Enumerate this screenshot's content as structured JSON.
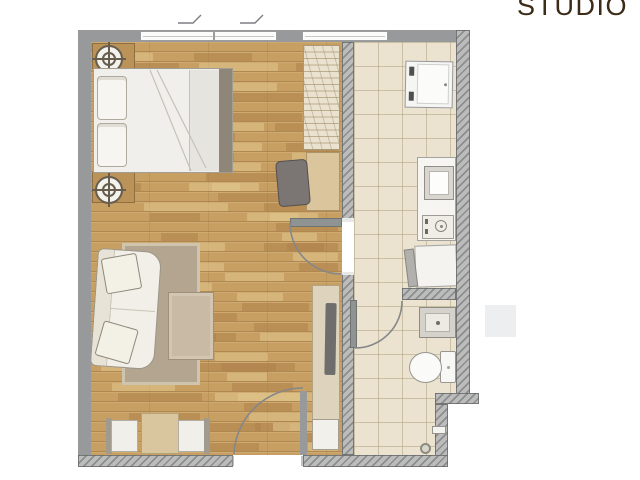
{
  "title": {
    "text": "STUDIO"
  },
  "floor_plan": {
    "type": "studio apartment floor plan",
    "rooms": [
      {
        "name": "bedroom-living-area",
        "floor": "wood"
      },
      {
        "name": "kitchen-hall",
        "floor": "tile"
      },
      {
        "name": "bathroom",
        "floor": "tile"
      }
    ],
    "furniture": [
      "nightstand-with-lamp (x2)",
      "double-bed",
      "wardrobe",
      "desk",
      "desk-chair",
      "sofa",
      "area-rug",
      "coffee-table",
      "tv-cabinet",
      "tv",
      "dining-table",
      "dining-chair (x2)",
      "shoe-cabinet"
    ],
    "kitchen_fixtures": [
      "refrigerator",
      "kitchen-counter",
      "sink",
      "cooktop",
      "base-cabinet"
    ],
    "bathroom_fixtures": [
      "washbasin",
      "toilet",
      "floor-drain",
      "shower-mixer"
    ],
    "doors": [
      "interior-door",
      "bathroom-door",
      "entry-door"
    ],
    "windows": [
      "double-window-top",
      "window-top-right"
    ]
  },
  "colors": {
    "title_text": "#3b2b17",
    "wall_solid": "#97999b",
    "wall_hatch": "#bcbdbb",
    "wood_floor": "#c79f63",
    "tile_floor": "#ebe3cf",
    "furniture_white": "#f1efe9",
    "furniture_wood": "#d8c49c",
    "rug": "#b3a58f",
    "tv": "#6f6e6c",
    "watermark": "#eceef0"
  }
}
